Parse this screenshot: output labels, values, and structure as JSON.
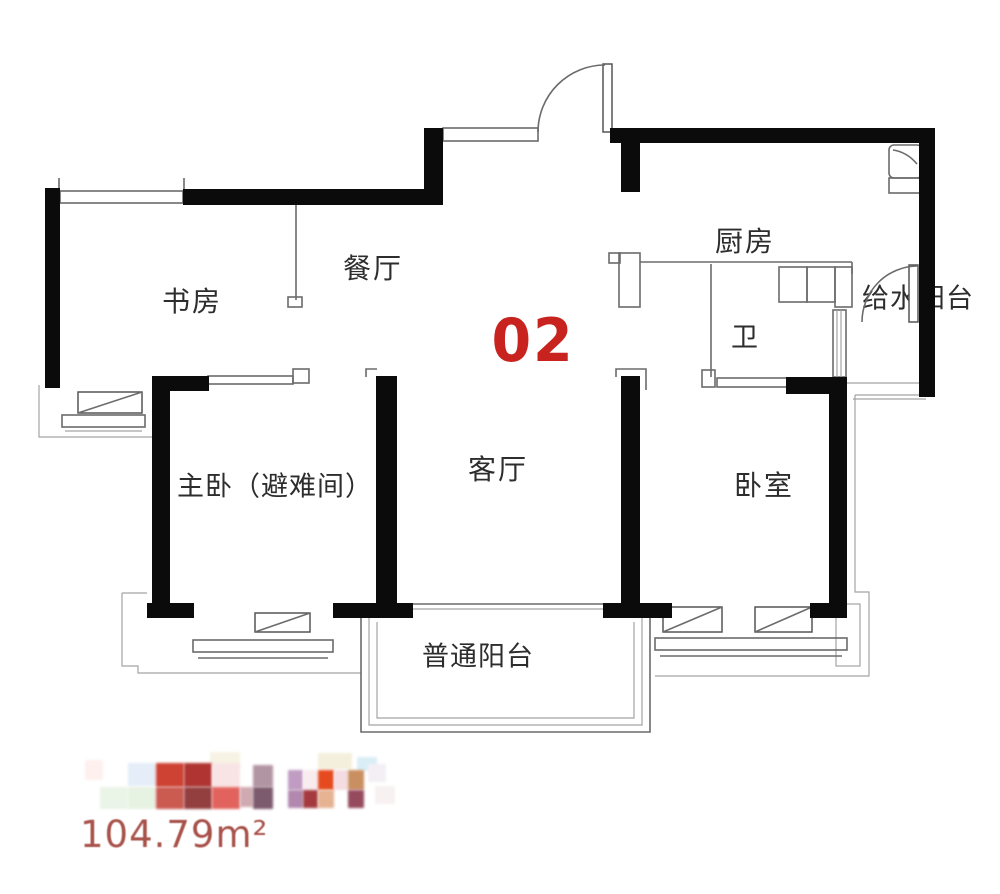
{
  "plan": {
    "type": "floorplan",
    "unit_number": "02",
    "area_label": "104.79m²"
  },
  "rooms": [
    {
      "id": "study",
      "label": "书房"
    },
    {
      "id": "dining",
      "label": "餐厅"
    },
    {
      "id": "kitchen",
      "label": "厨房"
    },
    {
      "id": "water-balcony",
      "label": "给水阳台"
    },
    {
      "id": "bath",
      "label": "卫"
    },
    {
      "id": "master",
      "label": "主卧（避难间）"
    },
    {
      "id": "living",
      "label": "客厅"
    },
    {
      "id": "bedroom",
      "label": "卧室"
    },
    {
      "id": "balcony",
      "label": "普通阳台"
    }
  ],
  "colors": {
    "background": "#ffffff",
    "wall": "#0b0b0b",
    "line": "#6b6b6b",
    "faint_line": "#a3a3a3",
    "label_text": "#2d2d2d",
    "unit_number": "#c8231f",
    "area_text": "#a8524b"
  },
  "watermark_logo": {
    "cells": [
      [
        210,
        752,
        30,
        16,
        "#f7f3e4"
      ],
      [
        318,
        753,
        34,
        16,
        "#f3efdc"
      ],
      [
        357,
        757,
        20,
        14,
        "#daeef6"
      ],
      [
        85,
        760,
        18,
        20,
        "#fdf0ef"
      ],
      [
        128,
        763,
        28,
        23,
        "#e4edf8"
      ],
      [
        156,
        763,
        28,
        24,
        "#ce4233"
      ],
      [
        184,
        763,
        28,
        24,
        "#b03431"
      ],
      [
        212,
        763,
        28,
        24,
        "#f8e4e5"
      ],
      [
        100,
        787,
        28,
        22,
        "#eaf4e7"
      ],
      [
        128,
        787,
        28,
        22,
        "#e6f2e2"
      ],
      [
        156,
        787,
        28,
        22,
        "#cb5a51"
      ],
      [
        184,
        787,
        28,
        22,
        "#943f3f"
      ],
      [
        212,
        787,
        28,
        22,
        "#e2635e"
      ],
      [
        253,
        765,
        20,
        22,
        "#b295a3"
      ],
      [
        240,
        787,
        13,
        20,
        "#d0aab1"
      ],
      [
        253,
        787,
        20,
        22,
        "#7d5b6e"
      ],
      [
        288,
        770,
        15,
        20,
        "#c09bc2"
      ],
      [
        303,
        770,
        15,
        20,
        "#f8ecef"
      ],
      [
        318,
        770,
        16,
        20,
        "#e64b20"
      ],
      [
        334,
        770,
        14,
        20,
        "#f4dce1"
      ],
      [
        348,
        770,
        16,
        20,
        "#c98f60"
      ],
      [
        288,
        790,
        15,
        18,
        "#b288ae"
      ],
      [
        303,
        790,
        15,
        18,
        "#a43a40"
      ],
      [
        318,
        790,
        16,
        18,
        "#e6b392"
      ],
      [
        348,
        790,
        16,
        18,
        "#964a5e"
      ],
      [
        368,
        764,
        18,
        18,
        "#f4eef5"
      ],
      [
        375,
        786,
        20,
        18,
        "#f7f1f1"
      ]
    ]
  }
}
